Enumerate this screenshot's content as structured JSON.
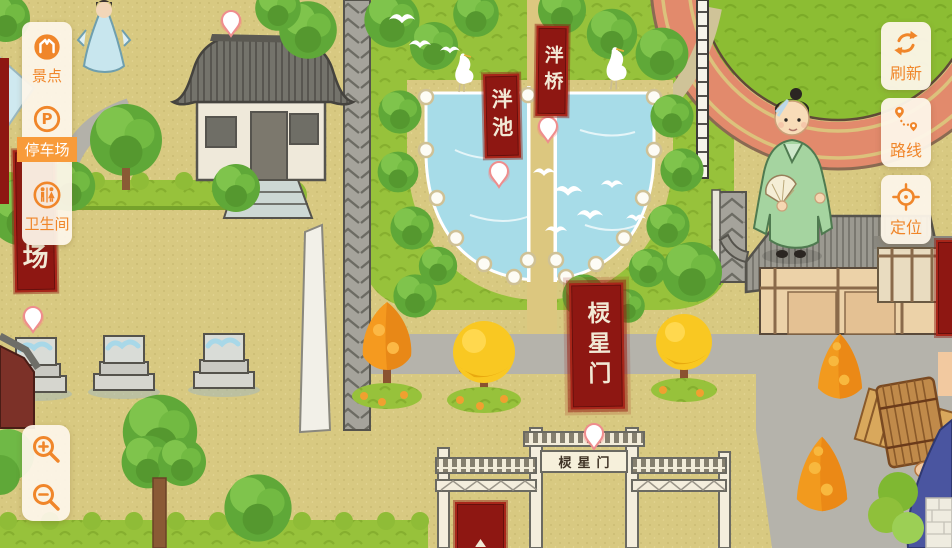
{
  "ui": {
    "sidebar": {
      "items": [
        {
          "label": "景点",
          "icon": "scenic-spot-icon",
          "selected": false
        },
        {
          "label": "停车场",
          "icon": "parking-icon",
          "selected": true
        },
        {
          "label": "卫生间",
          "icon": "restroom-icon",
          "selected": false
        }
      ]
    },
    "map_controls": {
      "zoom_in_icon": "zoom-in-icon",
      "zoom_out_icon": "zoom-out-icon"
    },
    "action_buttons": [
      {
        "label": "刷新",
        "icon": "refresh-icon"
      },
      {
        "label": "路线",
        "icon": "route-icon"
      },
      {
        "label": "定位",
        "icon": "locate-icon"
      }
    ]
  },
  "map": {
    "poi_banners": {
      "pan_bridge": "泮桥",
      "pan_pool": "泮池",
      "lingxing_gate": "棂星门",
      "parking_partial": "场"
    },
    "plaques": {
      "lingxing_gate": "棂星门"
    },
    "markers": {
      "pin_icon": "poi-pin-icon"
    },
    "colors": {
      "accent_orange": "#f0862a",
      "selected_item_bg": "#f89b3a",
      "panel_cream": "#fdf5e9",
      "banner_red": "#8e1712",
      "banner_border_red": "#a8261a",
      "ground_tan": "#d8c981",
      "lawn_green": "#97c23b",
      "pond_blue": "#a7dce8",
      "track_salmon": "#e28a6c",
      "road_gray": "#b5b3ab"
    }
  }
}
